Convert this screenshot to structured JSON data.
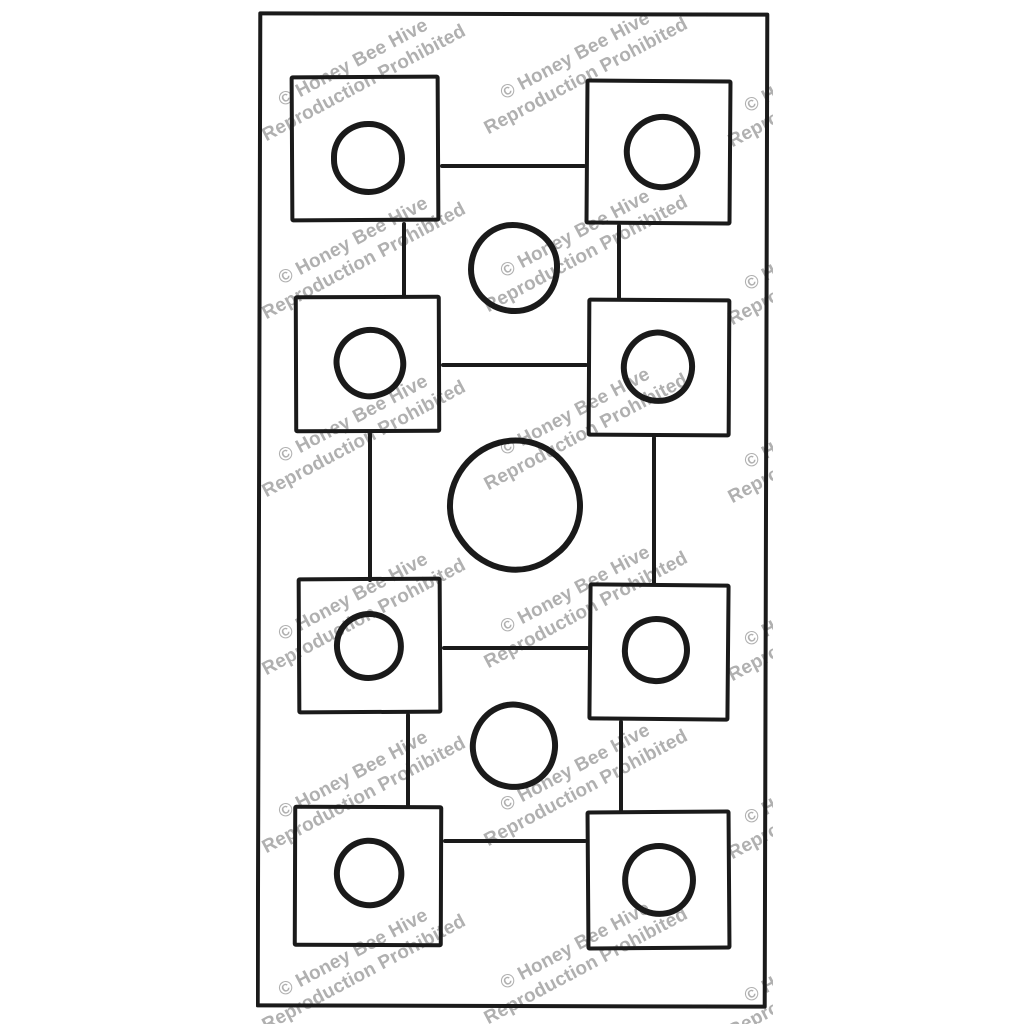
{
  "watermark": {
    "line1": "© Honey Bee Hive",
    "line2": "Reproduction Prohibited",
    "color": "#b0b0b0",
    "rotation_deg": -28,
    "font_size_px": 19,
    "positions": [
      {
        "x": 103,
        "y": 66
      },
      {
        "x": 325,
        "y": 59
      },
      {
        "x": 569,
        "y": 72
      },
      {
        "x": 103,
        "y": 244
      },
      {
        "x": 325,
        "y": 237
      },
      {
        "x": 569,
        "y": 250
      },
      {
        "x": 103,
        "y": 422
      },
      {
        "x": 325,
        "y": 415
      },
      {
        "x": 569,
        "y": 428
      },
      {
        "x": 103,
        "y": 600
      },
      {
        "x": 325,
        "y": 593
      },
      {
        "x": 569,
        "y": 606
      },
      {
        "x": 103,
        "y": 778
      },
      {
        "x": 325,
        "y": 771
      },
      {
        "x": 569,
        "y": 784
      },
      {
        "x": 103,
        "y": 956
      },
      {
        "x": 325,
        "y": 949
      },
      {
        "x": 569,
        "y": 962
      }
    ]
  },
  "pattern": {
    "ink_color": "#1a1a1a",
    "paper_color": "#ffffff",
    "outer_border": {
      "name": "pattern-outer-border",
      "x": 1,
      "y": 4,
      "w": 511,
      "h": 996,
      "rot": 0.15
    },
    "squares": [
      {
        "name": "square-row1-left",
        "x": 34,
        "y": 67,
        "w": 150,
        "h": 147,
        "rot": -0.3,
        "circle": {
          "name": "circle-in-square-row1-left",
          "x": 75,
          "y": 113,
          "d": 74
        }
      },
      {
        "name": "square-row1-right",
        "x": 329,
        "y": 71,
        "w": 147,
        "h": 146,
        "rot": 0.4,
        "circle": {
          "name": "circle-in-square-row1-right",
          "x": 368,
          "y": 106,
          "d": 76
        }
      },
      {
        "name": "square-row2-left",
        "x": 38,
        "y": 287,
        "w": 147,
        "h": 138,
        "rot": -0.2,
        "circle": {
          "name": "circle-in-square-row2-left",
          "x": 78,
          "y": 319,
          "d": 72
        }
      },
      {
        "name": "square-row2-right",
        "x": 331,
        "y": 290,
        "w": 144,
        "h": 139,
        "rot": 0.3,
        "circle": {
          "name": "circle-in-square-row2-right",
          "x": 365,
          "y": 322,
          "d": 74
        }
      },
      {
        "name": "square-row3-left",
        "x": 41,
        "y": 569,
        "w": 145,
        "h": 137,
        "rot": -0.3,
        "circle": {
          "name": "circle-in-square-row3-left",
          "x": 78,
          "y": 603,
          "d": 70
        }
      },
      {
        "name": "square-row3-right",
        "x": 332,
        "y": 575,
        "w": 142,
        "h": 138,
        "rot": 0.5,
        "circle": {
          "name": "circle-in-square-row3-right",
          "x": 366,
          "y": 608,
          "d": 68
        }
      },
      {
        "name": "square-row4-left",
        "x": 37,
        "y": 797,
        "w": 150,
        "h": 142,
        "rot": 0.2,
        "circle": {
          "name": "circle-in-square-row4-left",
          "x": 78,
          "y": 830,
          "d": 70
        }
      },
      {
        "name": "square-row4-right",
        "x": 330,
        "y": 802,
        "w": 145,
        "h": 140,
        "rot": -0.4,
        "circle": {
          "name": "circle-in-square-row4-right",
          "x": 366,
          "y": 835,
          "d": 74
        }
      }
    ],
    "free_circles": [
      {
        "name": "circle-center-top",
        "x": 212,
        "y": 214,
        "d": 92
      },
      {
        "name": "circle-center-large",
        "x": 192,
        "y": 430,
        "d": 134
      },
      {
        "name": "circle-center-bottom",
        "x": 214,
        "y": 694,
        "d": 88
      }
    ],
    "connectors": [
      {
        "name": "connector-row1-horizontal",
        "x": 184,
        "y": 156,
        "w": 146,
        "h": 4
      },
      {
        "name": "connector-row2-horizontal",
        "x": 185,
        "y": 355,
        "w": 147,
        "h": 4
      },
      {
        "name": "connector-row3-horizontal",
        "x": 186,
        "y": 638,
        "w": 147,
        "h": 4
      },
      {
        "name": "connector-row4-horizontal",
        "x": 187,
        "y": 831,
        "w": 144,
        "h": 4
      },
      {
        "name": "connector-left-1-2",
        "x": 146,
        "y": 214,
        "w": 4,
        "h": 76
      },
      {
        "name": "connector-left-2-3",
        "x": 112,
        "y": 424,
        "w": 4,
        "h": 150
      },
      {
        "name": "connector-left-3-4",
        "x": 150,
        "y": 705,
        "w": 4,
        "h": 95
      },
      {
        "name": "connector-right-1-2",
        "x": 361,
        "y": 216,
        "w": 4,
        "h": 76
      },
      {
        "name": "connector-right-2-3",
        "x": 396,
        "y": 428,
        "w": 4,
        "h": 150
      },
      {
        "name": "connector-right-3-4",
        "x": 363,
        "y": 712,
        "w": 4,
        "h": 92
      }
    ]
  }
}
